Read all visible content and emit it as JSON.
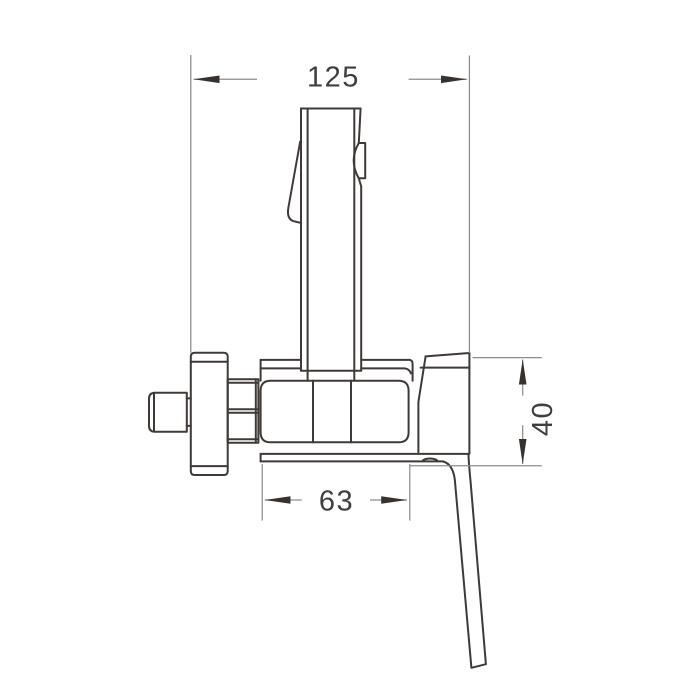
{
  "title": "Hand sprayer mixer valve - dimension drawing",
  "dimensions": {
    "width_top": {
      "label": "125",
      "position": "top"
    },
    "height_right": {
      "label": "40",
      "position": "right"
    },
    "width_bottom": {
      "label": "63",
      "position": "bottom"
    }
  },
  "colors": {
    "outline": "#3f3a38",
    "dimension_line": "#8d8d8d",
    "arrow": "#38322e",
    "text": "#3f3f3f",
    "background": "#ffffff"
  }
}
